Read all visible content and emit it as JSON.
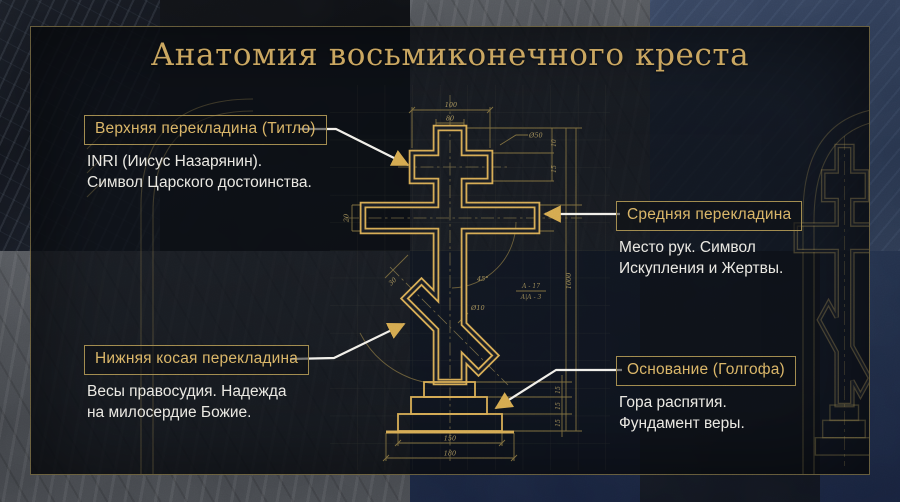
{
  "title": "Анатомия восьмиконечного креста",
  "callouts": [
    {
      "label": "Верхняя перекладина (Титло)",
      "desc": [
        "INRI (Иисус Назарянин).",
        "Символ Царского достоинства."
      ]
    },
    {
      "label": "Средняя перекладина",
      "desc": [
        "Место рук. Символ",
        "Искупления и Жертвы."
      ]
    },
    {
      "label": "Нижняя косая перекладина",
      "desc": [
        "Весы правосудия. Надежда",
        "на милосердие Божие."
      ]
    },
    {
      "label": "Основание (Голгофа)",
      "desc": [
        "Гора распятия.",
        "Фундамент веры."
      ]
    }
  ],
  "drawing": {
    "dimensions": {
      "top_width": "100",
      "post_width": "80",
      "hole": "Ø50",
      "right_a": "10",
      "right_b": "15",
      "bar_height": "20",
      "slant_width": "30",
      "angle": "45°",
      "small_hole": "Ø10",
      "ref_top": "А - 17",
      "ref_bottom": "А|А - 3",
      "base_inner": "150",
      "base_outer": "180",
      "step_a": "15",
      "step_b": "15",
      "step_c": "15",
      "total_height": "1000"
    }
  },
  "colors": {
    "accent_gold": "#d6ab54",
    "label_text": "#d9b466",
    "box_border": "#a0894d",
    "desc_text": "#eae8e2",
    "arrow_line": "#f1efe9",
    "panel_border": "#ac9656"
  }
}
